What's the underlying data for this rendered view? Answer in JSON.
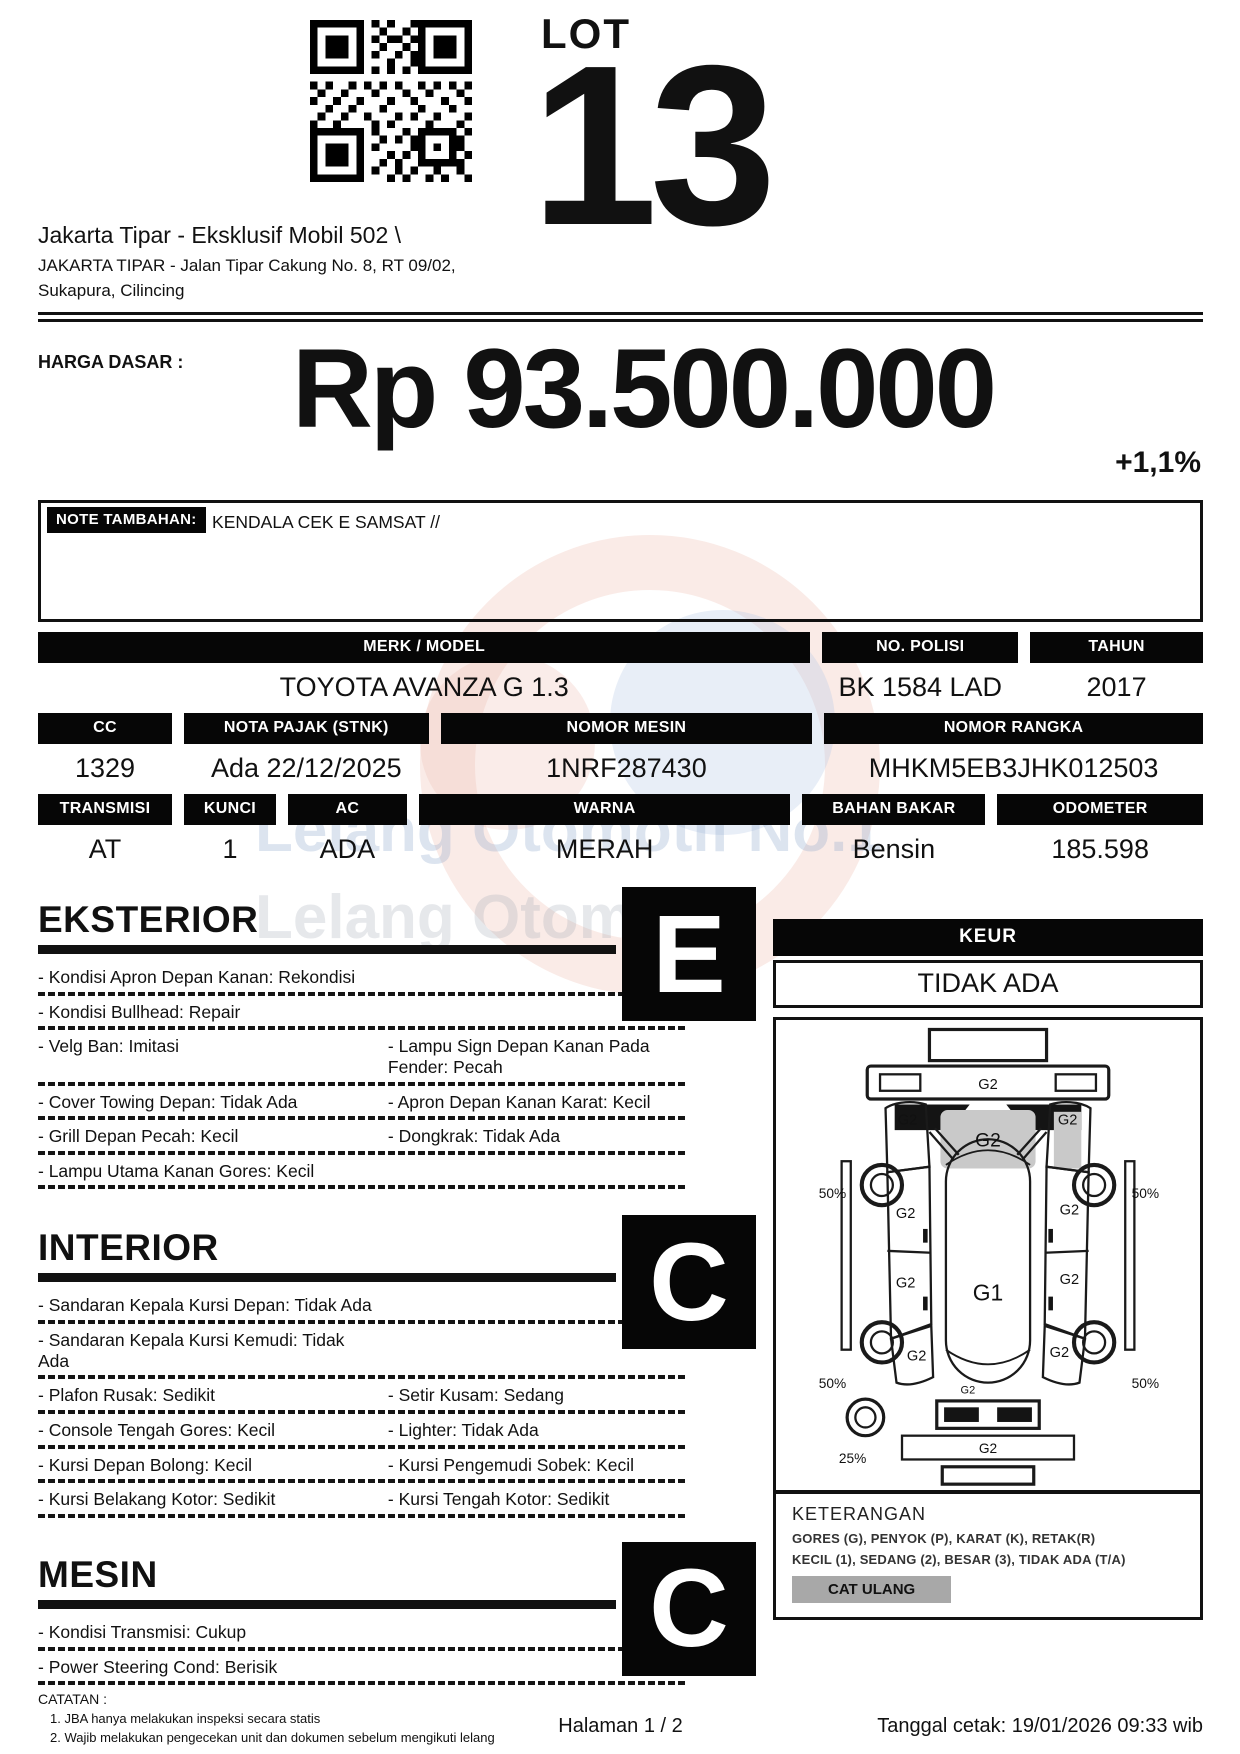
{
  "colors": {
    "bar_black": "#060606",
    "badge_gray": "#a8a8a8",
    "diagram_gray": "#c9c9c9"
  },
  "header": {
    "qr_icon": "qr-code",
    "lot_label": "LOT",
    "lot_number": "13",
    "address_line1": "Jakarta Tipar - Eksklusif Mobil 502 \\",
    "address_line2": "JAKARTA TIPAR - Jalan Tipar Cakung No. 8, RT 09/02,",
    "address_line3": "Sukapura, Cilincing"
  },
  "price": {
    "label": "HARGA DASAR :",
    "amount": "Rp 93.500.000",
    "change": "+1,1%"
  },
  "note": {
    "label": "NOTE TAMBAHAN:",
    "text": "KENDALA CEK E SAMSAT //"
  },
  "specs": {
    "merk_model": {
      "label": "MERK / MODEL",
      "value": "TOYOTA AVANZA G 1.3"
    },
    "no_polisi": {
      "label": "NO. POLISI",
      "value": "BK 1584 LAD"
    },
    "tahun": {
      "label": "TAHUN",
      "value": "2017"
    },
    "cc": {
      "label": "CC",
      "value": "1329"
    },
    "nota_pajak": {
      "label": "NOTA PAJAK (STNK)",
      "value": "Ada 22/12/2025"
    },
    "nomor_mesin": {
      "label": "NOMOR MESIN",
      "value": "1NRF287430"
    },
    "nomor_rangka": {
      "label": "NOMOR RANGKA",
      "value": "MHKM5EB3JHK012503"
    },
    "transmisi": {
      "label": "TRANSMISI",
      "value": "AT"
    },
    "kunci": {
      "label": "KUNCI",
      "value": "1"
    },
    "ac": {
      "label": "AC",
      "value": "ADA"
    },
    "warna": {
      "label": "WARNA",
      "value": "MERAH"
    },
    "bahan_bakar": {
      "label": "BAHAN BAKAR",
      "value": "Bensin"
    },
    "odometer": {
      "label": "ODOMETER",
      "value": "185.598"
    }
  },
  "sections": {
    "eksterior": {
      "title": "EKSTERIOR",
      "grade": "E",
      "rows": [
        {
          "left": "- Kondisi Apron Depan Kanan: Rekondisi",
          "right": ""
        },
        {
          "left": "- Kondisi Bullhead: Repair",
          "right": ""
        },
        {
          "left": "- Velg Ban: Imitasi",
          "right": "- Lampu Sign Depan Kanan Pada Fender: Pecah"
        },
        {
          "left": "- Cover Towing Depan: Tidak Ada",
          "right": "- Apron Depan Kanan Karat: Kecil"
        },
        {
          "left": "- Grill Depan Pecah: Kecil",
          "right": "- Dongkrak: Tidak Ada"
        },
        {
          "left": "- Lampu Utama Kanan Gores: Kecil",
          "right": ""
        }
      ]
    },
    "interior": {
      "title": "INTERIOR",
      "grade": "C",
      "rows": [
        {
          "left": "- Sandaran Kepala Kursi Depan: Tidak Ada",
          "right": ""
        },
        {
          "left": "- Sandaran Kepala Kursi Kemudi: Tidak Ada",
          "right": ""
        },
        {
          "left": "- Plafon Rusak: Sedikit",
          "right": "- Setir Kusam: Sedang"
        },
        {
          "left": "- Console Tengah Gores: Kecil",
          "right": "- Lighter: Tidak Ada"
        },
        {
          "left": "- Kursi Depan Bolong: Kecil",
          "right": "- Kursi Pengemudi Sobek: Kecil"
        },
        {
          "left": "- Kursi Belakang Kotor: Sedikit",
          "right": "- Kursi Tengah Kotor: Sedikit"
        }
      ]
    },
    "mesin": {
      "title": "MESIN",
      "grade": "C",
      "rows": [
        {
          "left": "- Kondisi Transmisi: Cukup",
          "right": ""
        },
        {
          "left": "- Power Steering Cond: Berisik",
          "right": ""
        }
      ]
    }
  },
  "keur": {
    "label": "KEUR",
    "value": "TIDAK ADA"
  },
  "diagram": {
    "labels": {
      "front_bumper": "G2",
      "left_front_fender": "G2",
      "right_front_fender": "G2",
      "hood": "G2",
      "front_left_wheel": "50%",
      "front_right_wheel": "50%",
      "front_left_door": "G2",
      "front_right_door": "G2",
      "rear_left_door": "G2",
      "rear_right_door": "G2",
      "roof": "G1",
      "rear_left_quarter": "G2",
      "rear_right_quarter": "G2",
      "rear_left_wheel": "50%",
      "rear_right_wheel": "50%",
      "rear_deck": "G2",
      "rear_bumper": "G2",
      "spare_wheel": "25%"
    }
  },
  "keterangan": {
    "title": "KETERANGAN",
    "line1": "GORES (G), PENYOK (P), KARAT (K), RETAK(R)",
    "line2": "KECIL (1), SEDANG (2), BESAR (3), TIDAK ADA (T/A)",
    "badge": "CAT ULANG"
  },
  "catatan": {
    "title": "CATATAN :",
    "item1": "1. JBA hanya melakukan inspeksi secara statis",
    "item2": "2. Wajib melakukan pengecekan unit dan dokumen sebelum mengikuti lelang"
  },
  "footer": {
    "page": "Halaman 1 / 2",
    "printed": "Tanggal cetak: 19/01/2026 09:33 wib"
  },
  "watermark": {
    "line1": "Lelang Otomotif No.1",
    "line2": "Lelang Otomotif"
  }
}
